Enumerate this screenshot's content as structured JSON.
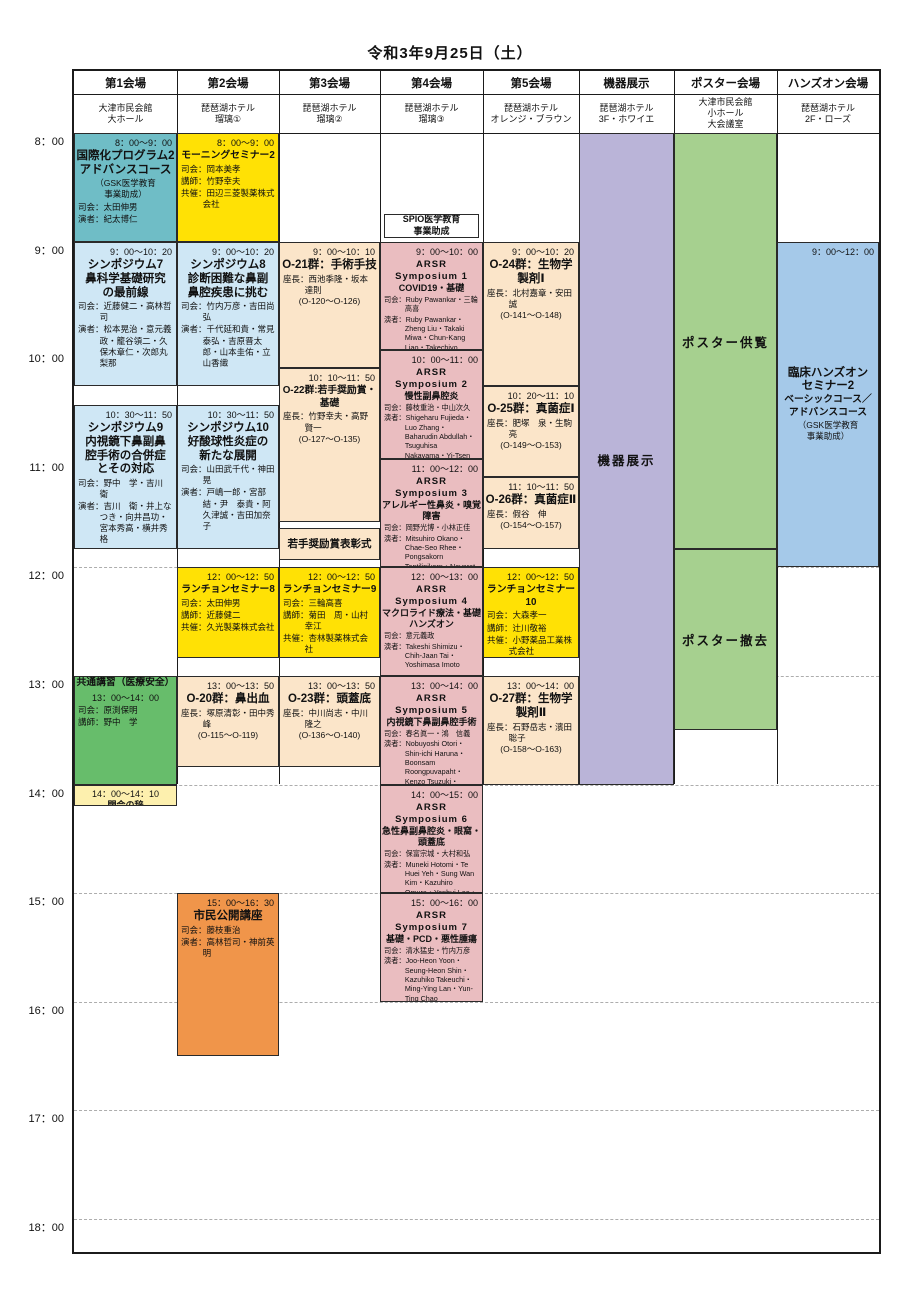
{
  "date_title": "令和3年9月25日（土）",
  "palette": {
    "teal": "#6fbdc6",
    "sky": "#cfe7f5",
    "yellow": "#ffe105",
    "peach": "#fbe5c9",
    "pink": "#eabdc0",
    "green": "#67bd6b",
    "paleyellow": "#fdf0ae",
    "orange": "#f0954a",
    "purple": "#bab4d8",
    "postergreen": "#a6d08f",
    "handsblue": "#a5c9e9",
    "white": "#ffffff"
  },
  "venues": [
    {
      "name": "第1会場",
      "hall": "大津市民会館\n大ホール"
    },
    {
      "name": "第2会場",
      "hall": "琵琶湖ホテル\n瑠璃①"
    },
    {
      "name": "第3会場",
      "hall": "琵琶湖ホテル\n瑠璃②"
    },
    {
      "name": "第4会場",
      "hall": "琵琶湖ホテル\n瑠璃③"
    },
    {
      "name": "第5会場",
      "hall": "琵琶湖ホテル\nオレンジ・ブラウン"
    },
    {
      "name": "機器展示",
      "hall": "琵琶湖ホテル\n3F・ホワイエ"
    },
    {
      "name": "ポスター会場",
      "hall": "大津市民会館\n小ホール\n大会議室"
    },
    {
      "name": "ハンズオン会場",
      "hall": "琵琶湖ホテル\n2F・ローズ"
    }
  ],
  "time_labels": [
    "8：00",
    "9：00",
    "10：00",
    "11：00",
    "12：00",
    "13：00",
    "14：00",
    "15：00",
    "16：00",
    "17：00",
    "18：00"
  ],
  "sessions": [
    {
      "id": "intl-program-2",
      "v": 0,
      "s": "8:00",
      "e": "9:00",
      "c": "teal",
      "lines": [
        [
          "time",
          "8：00～9：00"
        ],
        [
          "t1",
          "国際化プログラム2"
        ],
        [
          "t1",
          "アドバンスコース"
        ],
        [
          "cen",
          "（GSK医学教育"
        ],
        [
          "cen",
          "事業助成）"
        ],
        [
          "meta",
          "司会：太田伸男"
        ],
        [
          "meta",
          "演者：紀太博仁"
        ]
      ]
    },
    {
      "id": "symposium-7",
      "v": 0,
      "s": "9:00",
      "e": "10:20",
      "c": "sky",
      "lines": [
        [
          "time",
          "9：00～10：20"
        ],
        [
          "t1",
          "シンポジウム7"
        ],
        [
          "t1",
          "鼻科学基礎研究"
        ],
        [
          "t1",
          "の最前線"
        ],
        [
          "meta",
          "司会：近藤健二・高林哲司"
        ],
        [
          "meta",
          "演者：松本晃治・意元義政・籠谷領二・久保木章仁・次郎丸梨那"
        ]
      ]
    },
    {
      "id": "symposium-9",
      "v": 0,
      "s": "10:30",
      "e": "11:50",
      "c": "sky",
      "lines": [
        [
          "time",
          "10：30～11：50"
        ],
        [
          "t1",
          "シンポジウム9"
        ],
        [
          "t1",
          "内視鏡下鼻副鼻"
        ],
        [
          "t1",
          "腔手術の合併症"
        ],
        [
          "t1",
          "とその対応"
        ],
        [
          "meta",
          "司会：野中　学・吉川　衛"
        ],
        [
          "meta",
          "演者：吉川　衛・井上なつき・向井昌功・宮本秀高・横井秀格"
        ]
      ]
    },
    {
      "id": "common-lecture-medical-safety",
      "v": 0,
      "s": "13:00",
      "e": "14:00",
      "c": "green",
      "lines": [
        [
          "t1s",
          "共通講習（医療安全）"
        ],
        [
          "timec",
          "13：00～14：00"
        ],
        [
          "meta",
          "司会：原渕保明"
        ],
        [
          "meta",
          "講師：野中　学"
        ]
      ]
    },
    {
      "id": "closing-remarks",
      "v": 0,
      "s": "14:00",
      "e": "14:12",
      "c": "paleyellow",
      "lines": [
        [
          "timec",
          "14：00～14：10"
        ],
        [
          "arst",
          "閉会の辞"
        ]
      ]
    },
    {
      "id": "morning-seminar-2",
      "v": 1,
      "s": "8:00",
      "e": "9:00",
      "c": "yellow",
      "lines": [
        [
          "time",
          "8：00～9：00"
        ],
        [
          "t1s",
          "モーニングセミナー2"
        ],
        [
          "meta",
          "司会：岡本美孝"
        ],
        [
          "meta",
          "講師：竹野幸夫"
        ],
        [
          "meta",
          "共催：田辺三菱製薬株式会社"
        ]
      ]
    },
    {
      "id": "symposium-8",
      "v": 1,
      "s": "9:00",
      "e": "10:20",
      "c": "sky",
      "lines": [
        [
          "time",
          "9：00～10：20"
        ],
        [
          "t1",
          "シンポジウム8"
        ],
        [
          "t1",
          "診断困難な鼻副"
        ],
        [
          "t1",
          "鼻腔疾患に挑む"
        ],
        [
          "meta",
          "司会：竹内万彦・吉田尚弘"
        ],
        [
          "meta",
          "演者：千代延和貴・常見泰弘・吉原晋太郎・山本圭佑・立山香織"
        ]
      ]
    },
    {
      "id": "symposium-10",
      "v": 1,
      "s": "10:30",
      "e": "11:50",
      "c": "sky",
      "lines": [
        [
          "time",
          "10：30～11：50"
        ],
        [
          "t1",
          "シンポジウム10"
        ],
        [
          "t1",
          "好酸球性炎症の"
        ],
        [
          "t1",
          "新たな展開"
        ],
        [
          "meta",
          "司会：山田武千代・神田　晃"
        ],
        [
          "meta",
          "演者：戸嶋一郎・宮部　結・尹　泰貴・阿久津誠・吉田加奈子"
        ]
      ]
    },
    {
      "id": "luncheon-seminar-8",
      "v": 1,
      "s": "12:00",
      "e": "12:50",
      "c": "yellow",
      "lines": [
        [
          "time",
          "12：00～12：50"
        ],
        [
          "t1s",
          "ランチョンセミナー8"
        ],
        [
          "meta",
          "司会：太田伸男"
        ],
        [
          "meta",
          "講師：近藤健二"
        ],
        [
          "meta",
          "共催：久光製薬株式会社"
        ]
      ]
    },
    {
      "id": "o-20-epistaxis",
      "v": 1,
      "s": "13:00",
      "e": "13:50",
      "c": "peach",
      "lines": [
        [
          "time",
          "13：00～13：50"
        ],
        [
          "t1",
          "O-20群：鼻出血"
        ],
        [
          "meta",
          "座長：塚原清彰・田中秀峰"
        ],
        [
          "cen",
          "(O-115～O-119)"
        ]
      ]
    },
    {
      "id": "public-lecture",
      "v": 1,
      "s": "15:00",
      "e": "16:30",
      "c": "orange",
      "lines": [
        [
          "time",
          "15：00～16：30"
        ],
        [
          "t1",
          "市民公開講座"
        ],
        [
          "meta",
          "司会：藤枝重治"
        ],
        [
          "meta",
          "演者：高林哲司・神前英明"
        ]
      ]
    },
    {
      "id": "o-21-surgical-technique",
      "v": 2,
      "s": "9:00",
      "e": "10:10",
      "c": "peach",
      "lines": [
        [
          "time",
          "9：00～10：10"
        ],
        [
          "t1",
          "O-21群：手術手技"
        ],
        [
          "meta",
          "座長：西池季隆・坂本達則"
        ],
        [
          "cen",
          "(O-120～O-126)"
        ]
      ]
    },
    {
      "id": "o-22-young-award-basic",
      "v": 2,
      "s": "10:10",
      "e": "11:35",
      "c": "peach",
      "lines": [
        [
          "time",
          "10：10～11：50"
        ],
        [
          "t1s",
          "O-22群:若手奨励賞・"
        ],
        [
          "t1s",
          "基礎"
        ],
        [
          "meta",
          "座長：竹野幸夫・高野賢一"
        ],
        [
          "cen",
          "(O-127～O-135)"
        ]
      ]
    },
    {
      "id": "young-award-ceremony",
      "v": 2,
      "s": "11:38",
      "e": "11:56",
      "c": "peach",
      "mid": true,
      "lines": [
        [
          "cenb",
          "若手奨励賞表彰式"
        ]
      ]
    },
    {
      "id": "luncheon-seminar-9",
      "v": 2,
      "s": "12:00",
      "e": "12:50",
      "c": "yellow",
      "lines": [
        [
          "time",
          "12：00～12：50"
        ],
        [
          "t1s",
          "ランチョンセミナー9"
        ],
        [
          "meta",
          "司会：三輪高喜"
        ],
        [
          "meta",
          "講師：菊田　周・山村幸江"
        ],
        [
          "meta",
          "共催：杏林製薬株式会社"
        ]
      ]
    },
    {
      "id": "o-23-skull-base",
      "v": 2,
      "s": "13:00",
      "e": "13:50",
      "c": "peach",
      "lines": [
        [
          "time",
          "13：00～13：50"
        ],
        [
          "t1",
          "O-23群：頭蓋底"
        ],
        [
          "meta",
          "座長：中川尚志・中川隆之"
        ],
        [
          "cen",
          "(O-136～O-140)"
        ]
      ]
    },
    {
      "id": "spio-note",
      "v": 3,
      "s": "8:45",
      "e": "8:58",
      "c": "white",
      "inset": 4,
      "mid": true,
      "lines": [
        [
          "spio",
          "SPIO医学教育"
        ],
        [
          "spio",
          "事業助成"
        ]
      ]
    },
    {
      "id": "arsr-symposium-1",
      "v": 3,
      "s": "9:00",
      "e": "10:00",
      "c": "pink",
      "lines": [
        [
          "time",
          "9：00～10：00"
        ],
        [
          "ars",
          "ARSR"
        ],
        [
          "ars",
          "Symposium 1"
        ],
        [
          "arst",
          "COVID19・基礎"
        ],
        [
          "metas",
          "司会：Ruby Pawankar・三輪 高喜"
        ],
        [
          "metas",
          "演者：Ruby Pawankar・Zheng Liu・Takaki Miwa・Chun-Kang Liao・Takechiyo Yamada・Yuting Lin"
        ]
      ]
    },
    {
      "id": "arsr-symposium-2",
      "v": 3,
      "s": "10:00",
      "e": "11:00",
      "c": "pink",
      "lines": [
        [
          "time",
          "10：00～11：00"
        ],
        [
          "ars",
          "ARSR"
        ],
        [
          "ars",
          "Symposium 2"
        ],
        [
          "arst",
          "慢性副鼻腔炎"
        ],
        [
          "metas",
          "司会：藤枝重治・中山次久"
        ],
        [
          "metas",
          "演者：Shigeharu Fujieda・Luo Zhang・Baharudin Abdullah・Tsuguhisa Nakayama・Yi-Tsen Lin・Daichi Murakami"
        ]
      ]
    },
    {
      "id": "arsr-symposium-3",
      "v": 3,
      "s": "11:00",
      "e": "12:00",
      "c": "pink",
      "lines": [
        [
          "time",
          "11：00～12：00"
        ],
        [
          "ars",
          "ARSR"
        ],
        [
          "ars",
          "Symposium 3"
        ],
        [
          "arst",
          "アレルギー性鼻炎・嗅覚障害"
        ],
        [
          "metas",
          "司会：岡野光博・小林正佳"
        ],
        [
          "metas",
          "演者：Mitsuhiro Okano・Chae-Seo Rhee・Pongsakorn Tantilipikorn・Navarat Kasemsuk・Lin Lin・Masayoshi Kobayashi"
        ]
      ]
    },
    {
      "id": "arsr-symposium-4",
      "v": 3,
      "s": "12:00",
      "e": "13:00",
      "c": "pink",
      "lines": [
        [
          "time",
          "12：00～13：00"
        ],
        [
          "ars",
          "ARSR"
        ],
        [
          "ars",
          "Symposium 4"
        ],
        [
          "arst",
          "マクロライド療法・基礎ハンズオン"
        ],
        [
          "metas",
          "司会：意元義政"
        ],
        [
          "metas",
          "演者：Takeshi Shimizu・Chih-Jaan Tai・Yoshimasa Imoto"
        ]
      ]
    },
    {
      "id": "arsr-symposium-5",
      "v": 3,
      "s": "13:00",
      "e": "14:00",
      "c": "pink",
      "lines": [
        [
          "time",
          "13：00～14：00"
        ],
        [
          "ars",
          "ARSR"
        ],
        [
          "ars",
          "Symposium 5"
        ],
        [
          "arst",
          "内視鏡下鼻副鼻腔手術"
        ],
        [
          "metas",
          "司会：春名眞一・鴻　信義"
        ],
        [
          "metas",
          "演者：Nobuyoshi Otori・Shin-ichi Haruna・Boonsam Roongpuvapaht・Kenzo Tsuzuki・Yasuyuki Hinohira・Teik Ying Ng"
        ]
      ]
    },
    {
      "id": "arsr-symposium-6",
      "v": 3,
      "s": "14:00",
      "e": "15:00",
      "c": "pink",
      "lines": [
        [
          "time",
          "14：00～15：00"
        ],
        [
          "ars",
          "ARSR"
        ],
        [
          "ars",
          "Symposium 6"
        ],
        [
          "arst",
          "急性鼻副鼻腔炎・眼窩・頭蓋底"
        ],
        [
          "metas",
          "司会：保富宗城・大村和弘"
        ],
        [
          "metas",
          "演者：Muneki Hotomi・Te Huei Yeh・Sung Wan Kim・Kazuhiro Omura・Yenhui Lee・Yuwen Huang"
        ]
      ]
    },
    {
      "id": "arsr-symposium-7",
      "v": 3,
      "s": "15:00",
      "e": "16:00",
      "c": "pink",
      "lines": [
        [
          "time",
          "15：00～16：00"
        ],
        [
          "ars",
          "ARSR"
        ],
        [
          "ars",
          "Symposium 7"
        ],
        [
          "arst",
          "基礎・PCD・悪性腫瘍"
        ],
        [
          "metas",
          "司会：清水猛史・竹内万彦"
        ],
        [
          "metas",
          "演者：Joo-Heon Yoon・Seung-Heon Shin・Kazuhiko Takeuchi・Ming-Ying Lan・Yun-Ting Chao"
        ]
      ]
    },
    {
      "id": "o-24-biologics-1",
      "v": 4,
      "s": "9:00",
      "e": "10:20",
      "c": "peach",
      "lines": [
        [
          "time",
          "9：00～10：20"
        ],
        [
          "t1",
          "O-24群：生物学"
        ],
        [
          "t1",
          "製剤Ⅰ"
        ],
        [
          "meta",
          "座長：北村嘉章・安田　誠"
        ],
        [
          "cen",
          "(O-141～O-148)"
        ]
      ]
    },
    {
      "id": "o-25-mycosis-1",
      "v": 4,
      "s": "10:20",
      "e": "11:10",
      "c": "peach",
      "lines": [
        [
          "time",
          "10：20～11：10"
        ],
        [
          "t1",
          "O-25群：真菌症Ⅰ"
        ],
        [
          "meta",
          "座長：肥塚　泉・生駒　亮"
        ],
        [
          "cen",
          "(O-149～O-153)"
        ]
      ]
    },
    {
      "id": "o-26-mycosis-2",
      "v": 4,
      "s": "11:10",
      "e": "11:50",
      "c": "peach",
      "lines": [
        [
          "time",
          "11：10～11：50"
        ],
        [
          "t1",
          "O-26群：真菌症Ⅱ"
        ],
        [
          "meta",
          "座長：假谷　伸"
        ],
        [
          "cen",
          "(O-154～O-157)"
        ]
      ]
    },
    {
      "id": "luncheon-seminar-10",
      "v": 4,
      "s": "12:00",
      "e": "12:50",
      "c": "yellow",
      "lines": [
        [
          "time",
          "12：00～12：50"
        ],
        [
          "t1s",
          "ランチョンセミナー10"
        ],
        [
          "meta",
          "司会：大森孝一"
        ],
        [
          "meta",
          "講師：辻川敬裕"
        ],
        [
          "meta",
          "共催：小野薬品工業株式会社"
        ]
      ]
    },
    {
      "id": "o-27-biologics-2",
      "v": 4,
      "s": "13:00",
      "e": "14:00",
      "c": "peach",
      "lines": [
        [
          "time",
          "13：00～14：00"
        ],
        [
          "t1",
          "O-27群：生物学"
        ],
        [
          "t1",
          "製剤Ⅱ"
        ],
        [
          "meta",
          "座長：石野岳志・濱田聡子"
        ],
        [
          "cen",
          "(O-158～O-163)"
        ]
      ]
    },
    {
      "id": "equipment-exhibit",
      "v": 5,
      "s": "8:00",
      "e": "14:00",
      "c": "purple",
      "mid": true,
      "lines": [
        [
          "big",
          "機器展示"
        ]
      ]
    },
    {
      "id": "poster-viewing",
      "v": 6,
      "s": "8:00",
      "e": "11:50",
      "c": "postergreen",
      "mid": true,
      "lines": [
        [
          "big",
          "ポスター供覧"
        ]
      ]
    },
    {
      "id": "poster-removal",
      "v": 6,
      "s": "11:50",
      "e": "13:30",
      "c": "postergreen",
      "mid": true,
      "lines": [
        [
          "big",
          "ポスター撤去"
        ]
      ]
    },
    {
      "id": "clinical-handson-seminar-2",
      "v": 7,
      "s": "9:00",
      "e": "12:00",
      "c": "handsblue",
      "mid": true,
      "lines": [
        [
          "time-abs",
          "9：00～12：00"
        ],
        [
          "t1",
          "臨床ハンズオン"
        ],
        [
          "t1",
          "セミナー2"
        ],
        [
          "t1s",
          "ベーシックコース／"
        ],
        [
          "t1s",
          "アドバンスコース"
        ],
        [
          "cen",
          "（GSK医学教育"
        ],
        [
          "cen",
          "事業助成）"
        ]
      ]
    }
  ]
}
